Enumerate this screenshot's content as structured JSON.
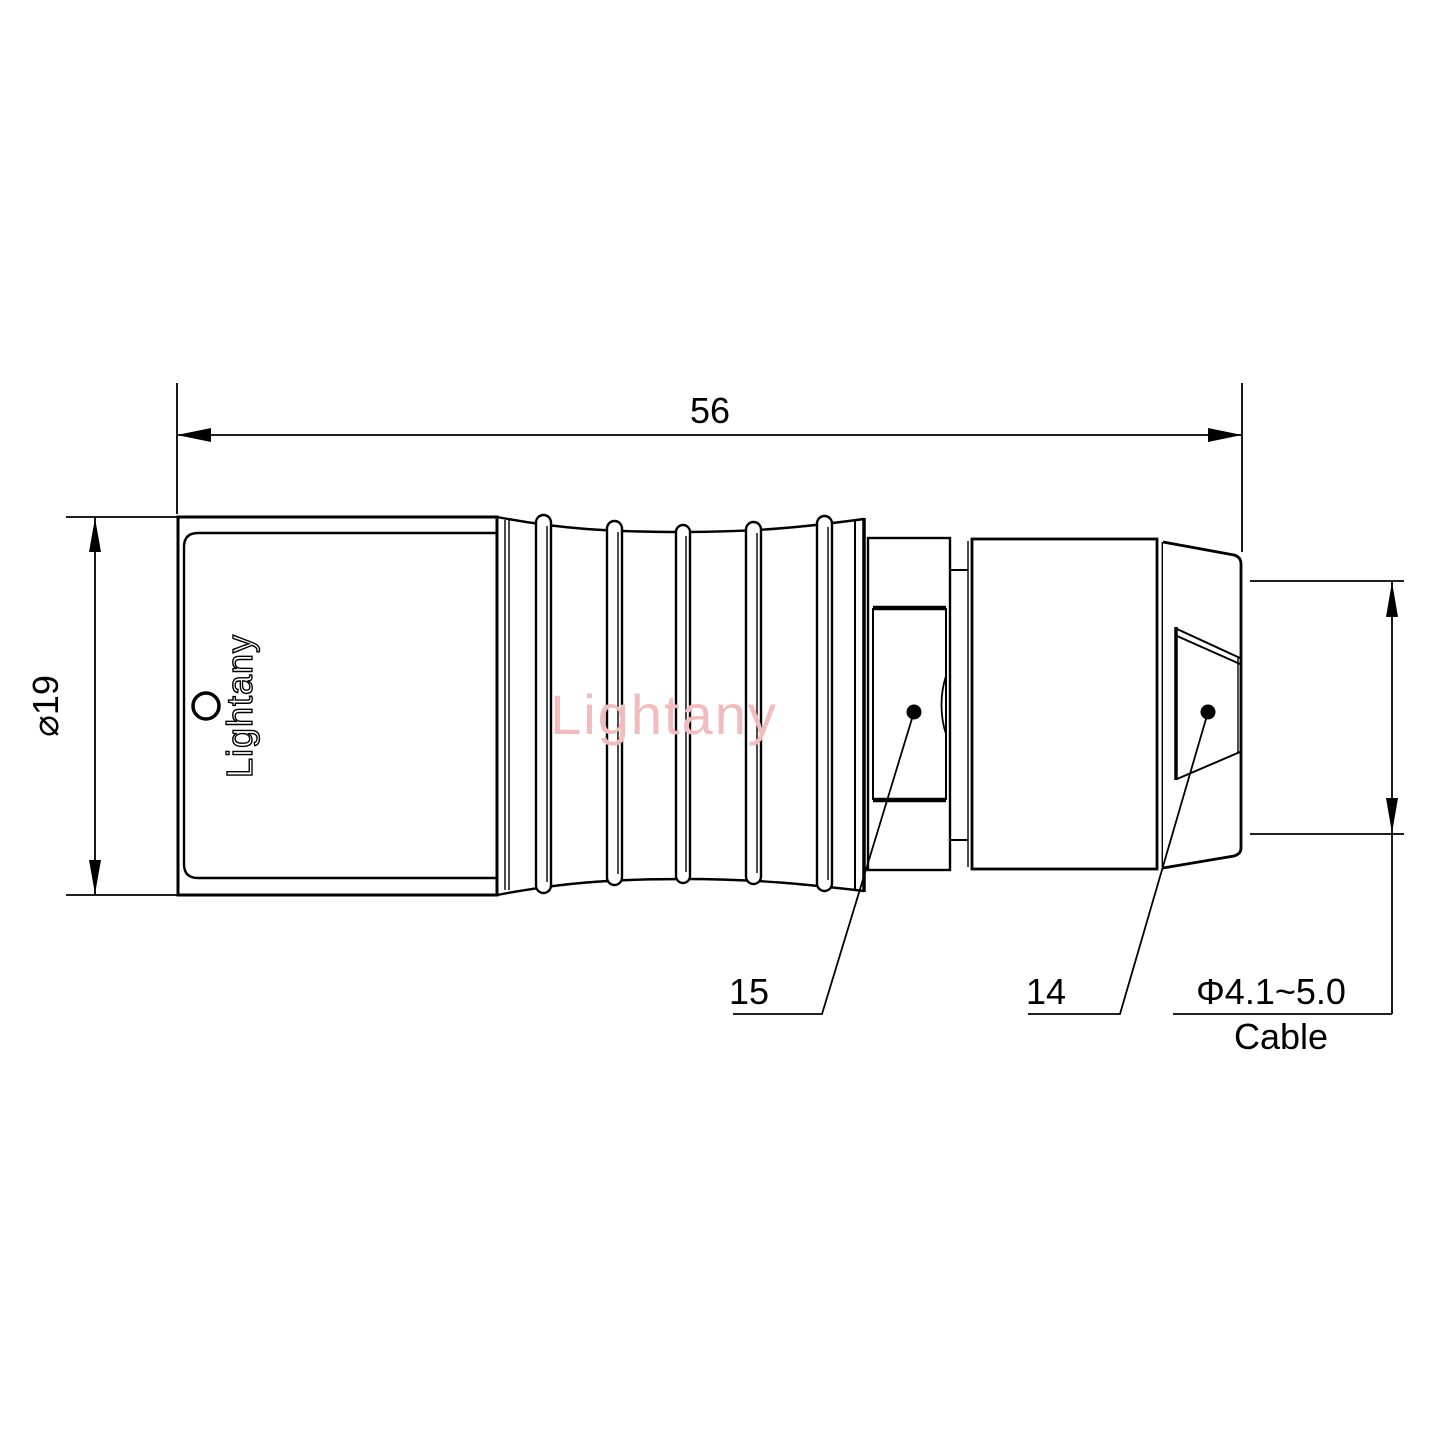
{
  "labels": {
    "length": "56",
    "diameter": "⌀19",
    "part_collet": "15",
    "part_nut": "14",
    "cable_diameter": "Φ4.1~5.0",
    "cable": "Cable",
    "brand_embossed": "Lightany",
    "watermark": "Lightany"
  },
  "colors": {
    "line": "#000000",
    "background": "#ffffff",
    "watermark": "#f2bcbc"
  }
}
